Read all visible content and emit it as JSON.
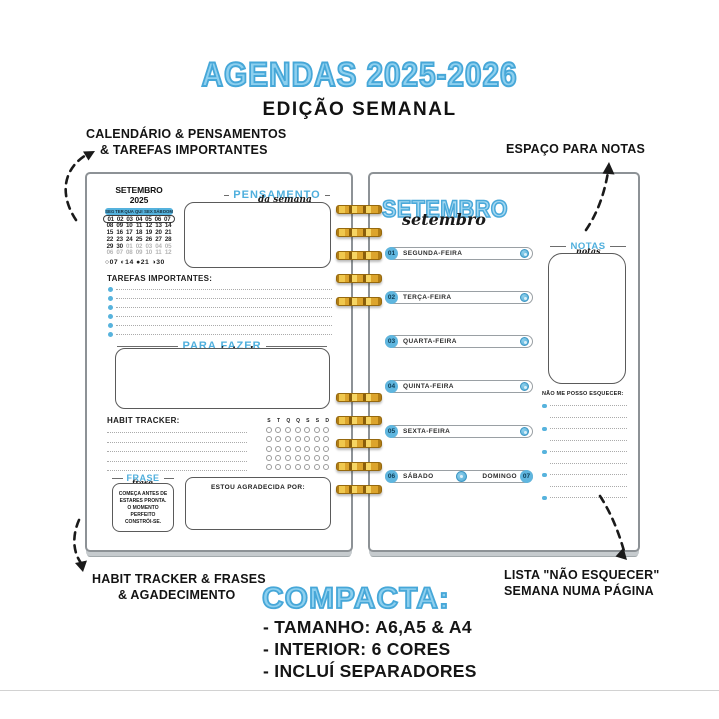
{
  "header": {
    "title": "AGENDAS 2025-2026",
    "subtitle": "EDIÇÃO SEMANAL"
  },
  "annotations": {
    "top_left": [
      "CALENDÁRIO & PENSAMENTOS",
      "& TAREFAS IMPORTANTES"
    ],
    "top_right": "ESPAÇO PARA NOTAS",
    "bottom_left": [
      "HABIT TRACKER & FRASES",
      "& AGADECIMENTO"
    ],
    "bottom_right": [
      "LISTA \"NÃO ESQUECER\"",
      "SEMANA NUMA PÁGINA"
    ]
  },
  "left_page": {
    "calendar": {
      "title": "SETEMBRO 2025",
      "weekdays": [
        "SEG",
        "TER",
        "QUA",
        "QUI",
        "SEX",
        "SÁB",
        "DOM"
      ],
      "weeks": [
        [
          "01",
          "02",
          "03",
          "04",
          "05",
          "06",
          "07"
        ],
        [
          "08",
          "09",
          "10",
          "11",
          "12",
          "13",
          "14"
        ],
        [
          "15",
          "16",
          "17",
          "18",
          "19",
          "20",
          "21"
        ],
        [
          "22",
          "23",
          "24",
          "25",
          "26",
          "27",
          "28"
        ],
        [
          "29",
          "30",
          "01",
          "02",
          "03",
          "04",
          "05"
        ],
        [
          "06",
          "07",
          "08",
          "09",
          "10",
          "11",
          "12"
        ]
      ],
      "muted_cells": {
        "4": 2,
        "5": 0
      },
      "moon_phases": [
        "○07",
        "◐14",
        "●21",
        "◑30"
      ]
    },
    "pensamento": {
      "title": "PENSAMENTO",
      "script": "da semana"
    },
    "tarefas_label": "TAREFAS IMPORTANTES:",
    "tarefas_line_count": 6,
    "para_fazer": {
      "title": "PARA FAZER",
      "script": "mais tarde"
    },
    "habit_tracker": {
      "label": "HABIT TRACKER:",
      "columns": [
        "S",
        "T",
        "Q",
        "Q",
        "S",
        "S",
        "D"
      ],
      "rows": 5,
      "line_count": 5
    },
    "frase": {
      "title": "FRASE",
      "script": "frase",
      "text": "COMEÇA ANTES DE ESTARES PRONTA. O MOMENTO PERFEITO CONSTRÓI-SE."
    },
    "gratidao_label": "ESTOU AGRADECIDA POR:"
  },
  "right_page": {
    "month_title": "SETEMBRO",
    "month_script": "setembro",
    "days": [
      {
        "num": "01",
        "name": "SEGUNDA-FEIRA"
      },
      {
        "num": "02",
        "name": "TERÇA-FEIRA"
      },
      {
        "num": "03",
        "name": "QUARTA-FEIRA"
      },
      {
        "num": "04",
        "name": "QUINTA-FEIRA"
      },
      {
        "num": "05",
        "name": "SEXTA-FEIRA"
      }
    ],
    "weekend": {
      "sat_num": "06",
      "sat_name": "SÁBADO",
      "sun_name": "DOMINGO",
      "sun_num": "07"
    },
    "notas": {
      "title": "NOTAS",
      "script": "notas"
    },
    "esquecer_label": "NÃO ME POSSO ESQUECER:",
    "esquecer_line_count": 9
  },
  "footer": {
    "title": "COMPACTA:",
    "items": [
      "- TAMANHO: A6,A5 & A4",
      "- INTERIOR: 6 CORES",
      "- INCLUÍ SEPARADORES"
    ]
  },
  "colors": {
    "accent_blue": "#56b3de",
    "title_blue": "#8ed0ef",
    "spiral_gold": "#dca42c"
  }
}
